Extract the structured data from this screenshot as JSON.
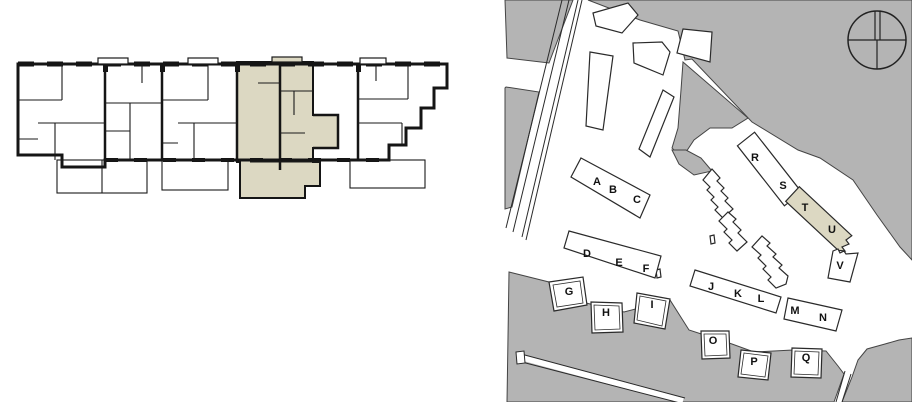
{
  "page": {
    "background": "#ffffff"
  },
  "floor_plan": {
    "highlight_color": "#dcd8c2",
    "line_color": "#151515"
  },
  "site_plan": {
    "ground_color": "#b4b4b4",
    "building_fill": "#ffffff",
    "highlight_color": "#dcd8c2",
    "line_color": "#2a2a2a",
    "compass_icon": "compass-north-icon",
    "building_labels": [
      {
        "label": "A",
        "x": 101,
        "y": 182
      },
      {
        "label": "B",
        "x": 117,
        "y": 190
      },
      {
        "label": "C",
        "x": 141,
        "y": 200
      },
      {
        "label": "D",
        "x": 91,
        "y": 254
      },
      {
        "label": "E",
        "x": 123,
        "y": 263
      },
      {
        "label": "F",
        "x": 150,
        "y": 269
      },
      {
        "label": "G",
        "x": 73,
        "y": 292
      },
      {
        "label": "H",
        "x": 110,
        "y": 313
      },
      {
        "label": "I",
        "x": 156,
        "y": 305
      },
      {
        "label": "J",
        "x": 215,
        "y": 287
      },
      {
        "label": "K",
        "x": 242,
        "y": 294
      },
      {
        "label": "L",
        "x": 265,
        "y": 299
      },
      {
        "label": "M",
        "x": 299,
        "y": 311
      },
      {
        "label": "N",
        "x": 327,
        "y": 318
      },
      {
        "label": "O",
        "x": 217,
        "y": 341
      },
      {
        "label": "P",
        "x": 258,
        "y": 362
      },
      {
        "label": "Q",
        "x": 310,
        "y": 358
      },
      {
        "label": "R",
        "x": 259,
        "y": 158
      },
      {
        "label": "S",
        "x": 287,
        "y": 186
      },
      {
        "label": "T",
        "x": 309,
        "y": 208
      },
      {
        "label": "U",
        "x": 336,
        "y": 230
      },
      {
        "label": "V",
        "x": 344,
        "y": 266
      }
    ]
  }
}
